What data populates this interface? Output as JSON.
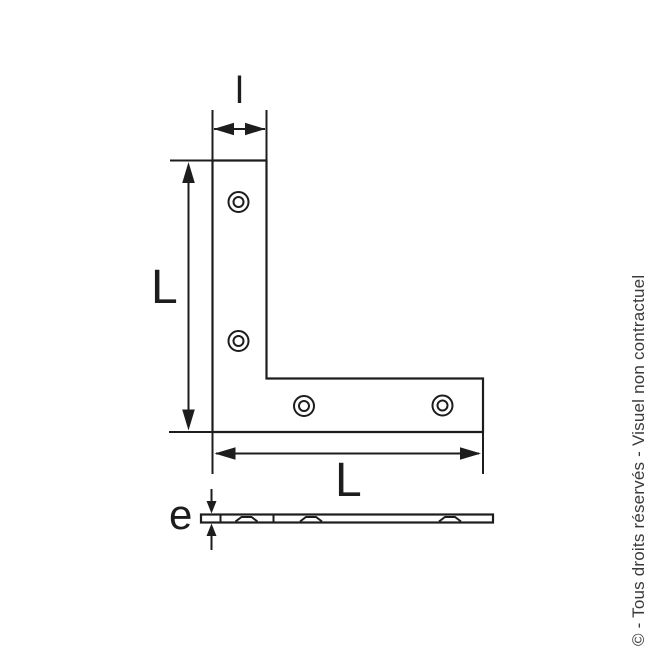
{
  "figure": {
    "description_labels": {
      "top_width": "l",
      "left_length": "L",
      "bottom_length": "L",
      "thickness": "e"
    },
    "colors": {
      "line": "#1d1d1d",
      "background": "#ffffff",
      "watermark_text": "#3a3a3a"
    }
  },
  "watermark": {
    "text": "© - Tous droits réservés - Visuel non contractuel"
  }
}
